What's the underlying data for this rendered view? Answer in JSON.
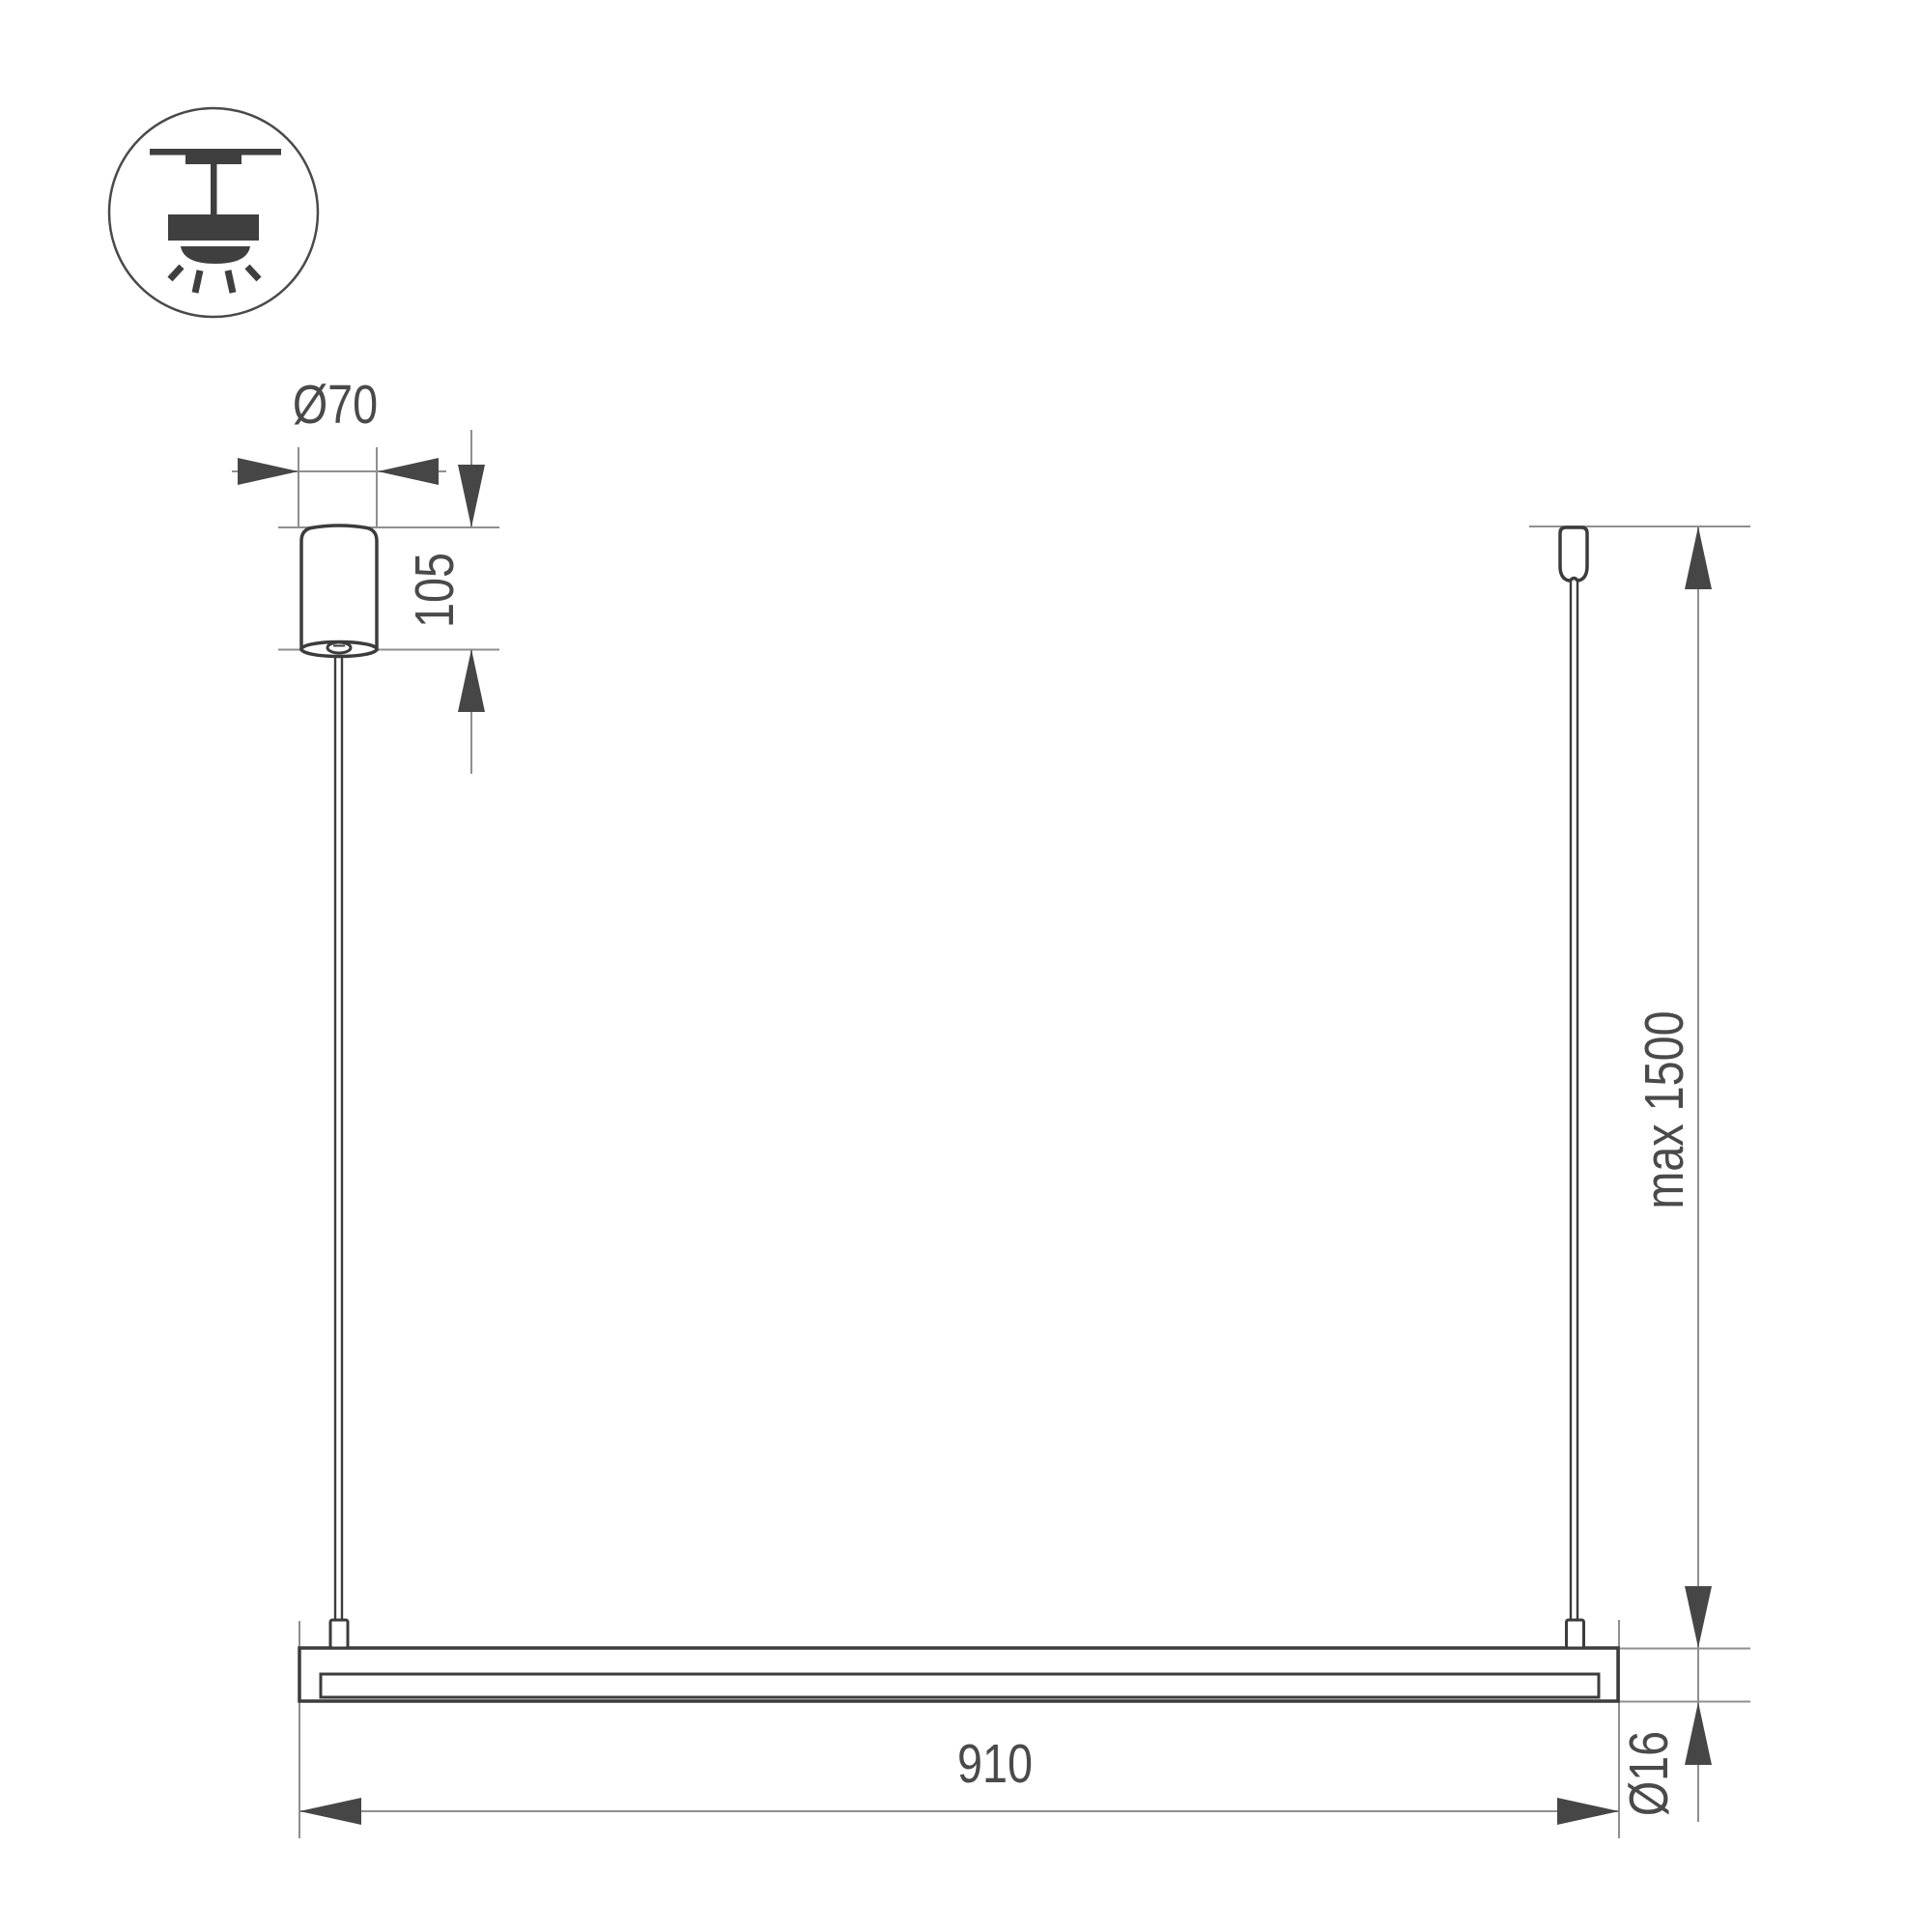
{
  "dimensions": {
    "canopy_diameter": "Ø70",
    "canopy_height": "105",
    "suspension_length": "max 1500",
    "fixture_length": "910",
    "tube_diameter": "Ø16"
  },
  "icon": {
    "name": "ceiling-pendant-light-icon"
  },
  "colors": {
    "outline_dark": "#3c3c3c",
    "thin_line": "#8f8f8f",
    "arrow_fill": "#464646",
    "text": "#4a4a4a",
    "background": "#ffffff"
  }
}
